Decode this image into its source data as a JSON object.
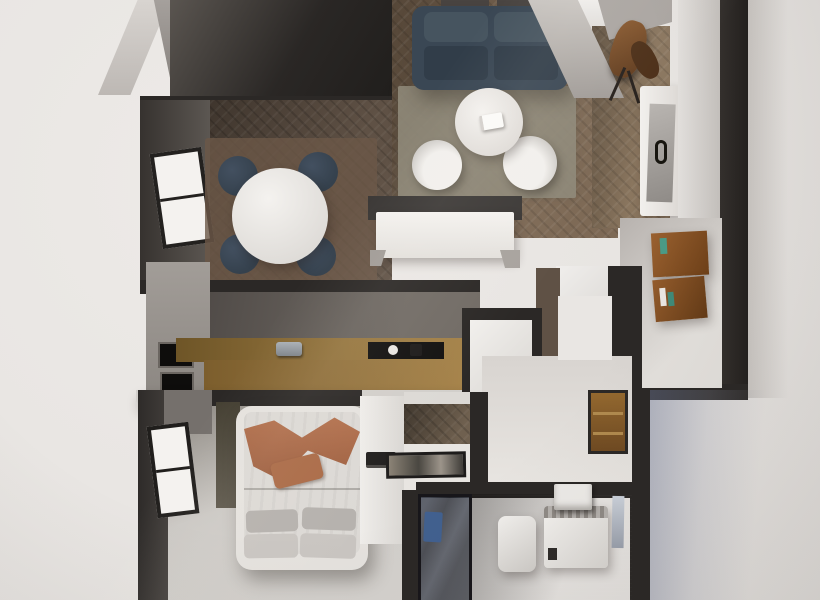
{
  "meta": {
    "kind": "photorealistic top-down 3D render of a one-bedroom apartment floor plan",
    "view": "orthographic top-down (doll-house)",
    "canvas": {
      "width_px": 820,
      "height_px": 600
    },
    "visible_text": "none"
  },
  "palette": {
    "bg": "#ebe8e5",
    "wall_dark": "#2b2826",
    "wall_mid": "#4a4542",
    "wall_gray": "#8f8a85",
    "wall_light": "#c7c3bf",
    "white_wall": "#e5e2de",
    "wood_floor": "#7d6955",
    "wood_floor_dark": "#5f5145",
    "wood_floor_entry": "#8a765f",
    "floor_light": "#cbc8c4",
    "rug_living": "#8e8878",
    "rug_dining": "#6b5847",
    "sofa_navy": "#3a4754",
    "sofa_cushion": "#46545f",
    "sofa_seat": "#313d49",
    "chair_navy": "#35414d",
    "white_furniture": "#f0eeeb",
    "oak_counter": "#96763f",
    "oak_counter_dark": "#6e5527",
    "counter_edge": "#d2cfcb",
    "cabinet_gray": "#9a9590",
    "appliance_black": "#0e0d0c",
    "backsplash": "#56514d",
    "terracotta": "#b3714e",
    "terracotta_dark": "#9a5c3d",
    "pillow_gray": "#b5b1ad",
    "pillow_light": "#c9c5c1",
    "bed_frame": "#e5e2de",
    "mattress": "#dcd9d5",
    "olive_wall": "#4a4437",
    "door_wood": "#8a5e31",
    "shelf_wood": "#8a5527",
    "book_teal": "#4a9a85",
    "towel_blue": "#41608f",
    "bath_floor": "#3c3937",
    "glass_tint": "rgba(35,40,52,0.6)",
    "mirror": "#ccd2db",
    "exterior_shadow": "rgba(108,118,148,0.45)"
  },
  "rooms": {
    "loggia": {
      "id": "loggia",
      "features": [
        "dark-floor",
        "glazed-partition-frames"
      ]
    },
    "dining_area": {
      "id": "dining-area",
      "furniture": [
        "round-dining-table",
        "dining-chair",
        "dining-chair",
        "dining-chair",
        "dining-chair",
        "dining-rug"
      ],
      "features": [
        "side-window",
        "herringbone-floor"
      ]
    },
    "living_room": {
      "id": "living-room",
      "furniture": [
        "navy-sofa",
        "area-rug",
        "round-coffee-table",
        "book-on-table",
        "lounge-chair",
        "lounge-chair",
        "tv-sideboard"
      ],
      "features": [
        "herringbone-floor"
      ]
    },
    "entry_hall": {
      "id": "entry-hall",
      "furniture": [
        "coat-rack",
        "console-cabinet",
        "wall-bookshelf"
      ],
      "features": [
        "herringbone-floor"
      ]
    },
    "kitchen": {
      "id": "kitchen",
      "furniture": [
        "gray-tall-cabinets",
        "built-in-oven",
        "built-in-microwave",
        "oak-island-counter",
        "sink-faucet",
        "black-cooktop",
        "kettle",
        "fridge-tall-unit"
      ],
      "features": [
        "dark-backsplash-wall"
      ]
    },
    "hallway": {
      "id": "hallway",
      "furniture": [
        "wooden-entrance-door"
      ],
      "features": [
        "white-walls"
      ]
    },
    "bedroom": {
      "id": "bedroom",
      "furniture": [
        "double-bed",
        "terracotta-throw",
        "throw-pillow",
        "bed-pillows",
        "dresser",
        "laptop-on-dresser"
      ],
      "features": [
        "side-window",
        "olive-accent-wall",
        "light-carpet-floor"
      ]
    },
    "dressing_room": {
      "id": "dressing-room",
      "furniture": [
        "decorative-floor-tray"
      ],
      "features": [
        "herringbone-strip",
        "white-floor"
      ]
    },
    "bathroom": {
      "id": "bathroom",
      "furniture": [
        "glass-shower",
        "blue-towel",
        "waste-bin",
        "washing-machine",
        "wall-sink",
        "mirror"
      ],
      "features": [
        "dark-tile-floor"
      ]
    }
  }
}
